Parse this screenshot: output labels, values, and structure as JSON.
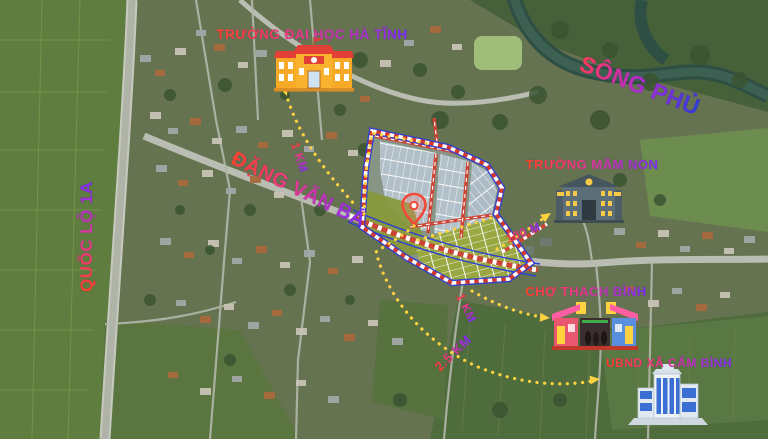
{
  "map": {
    "landmarks": {
      "university": {
        "label": "TRƯỜNG ĐẠI HỌC HÀ TĨNH",
        "distance": "1 KM"
      },
      "river": {
        "label": "SÔNG PHỦ"
      },
      "highway": {
        "label": "QUỐC LỘ 1A"
      },
      "street": {
        "label": "ĐẶNG VĂN BÁ"
      },
      "kindergarten": {
        "label": "TRƯỜNG MẦM NON",
        "distance": "100 M"
      },
      "market": {
        "label": "CHỢ THẠCH BÌNH",
        "distance": "1 KM"
      },
      "committee": {
        "label": "UBND XÃ CẨM BÌNH",
        "distance": "2.5 KM"
      }
    },
    "colors": {
      "label_gradient_start": "#ff4326",
      "label_gradient_mid": "#e93a8c",
      "label_gradient_end": "#7b2ff7",
      "river_label_start": "#ff3b57",
      "river_label_end": "#2b3fd6",
      "route_dots": "#ffd23f",
      "plan_boundary_red": "#d8372b",
      "plan_boundary_blue": "#2b3fd6",
      "plan_lots_fill": "#b4c3cd",
      "plan_green_zone": "#87983a",
      "pin": "#f2483a"
    }
  }
}
